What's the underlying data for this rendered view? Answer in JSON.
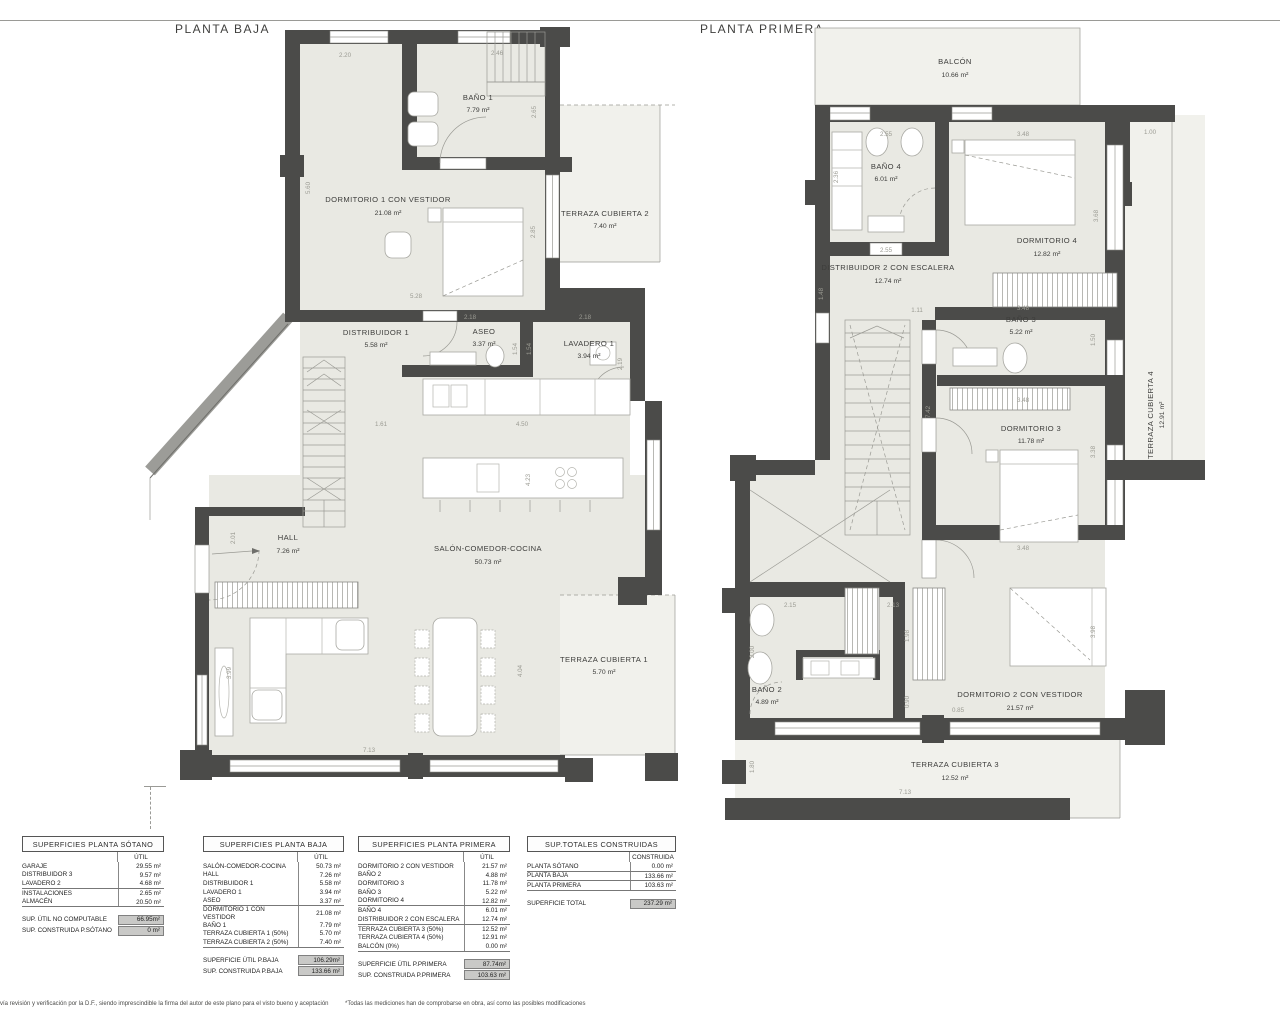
{
  "plans": {
    "baja": {
      "title": "PLANTA BAJA",
      "rooms": {
        "bano1": {
          "name": "BAÑO 1",
          "area": "7.79 m²"
        },
        "dorm1": {
          "name": "DORMITORIO 1 CON VESTIDOR",
          "area": "21.08 m²"
        },
        "terr2": {
          "name": "TERRAZA CUBIERTA 2",
          "area": "7.40 m²"
        },
        "dist1": {
          "name": "DISTRIBUIDOR 1",
          "area": "5.58 m²"
        },
        "aseo": {
          "name": "ASEO",
          "area": "3.37 m²"
        },
        "lav1": {
          "name": "LAVADERO 1",
          "area": "3.94 m²"
        },
        "hall": {
          "name": "HALL",
          "area": "7.26 m²"
        },
        "salon": {
          "name": "SALÓN-COMEDOR-COCINA",
          "area": "50.73 m²"
        },
        "terr1": {
          "name": "TERRAZA CUBIERTA 1",
          "area": "5.70 m²"
        }
      },
      "dims": [
        "2.20",
        "2.46",
        "5.60",
        "2.65",
        "2.85",
        "5.28",
        "2.18",
        "2.18",
        "1.54",
        "1.54",
        "2.19",
        "1.61",
        "4.50",
        "4.23",
        "2.01",
        "3.99",
        "7.13",
        "4.04"
      ]
    },
    "primera": {
      "title": "PLANTA PRIMERA",
      "rooms": {
        "balcon": {
          "name": "BALCÓN",
          "area": "10.66 m²"
        },
        "bano4": {
          "name": "BAÑO 4",
          "area": "6.01 m²"
        },
        "dorm4": {
          "name": "DORMITORIO 4",
          "area": "12.82 m²"
        },
        "dist2": {
          "name": "DISTRIBUIDOR 2 CON ESCALERA",
          "area": "12.74 m²"
        },
        "bano3": {
          "name": "BAÑO 3",
          "area": "5.22 m²"
        },
        "dorm3": {
          "name": "DORMITORIO 3",
          "area": "11.78 m²"
        },
        "terr4": {
          "name": "TERRAZA CUBIERTA 4",
          "area": "12.91 m²"
        },
        "bano2": {
          "name": "BAÑO 2",
          "area": "4.89 m²"
        },
        "dorm2": {
          "name": "DORMITORIO 2 CON VESTIDOR",
          "area": "21.57 m²"
        },
        "terr3": {
          "name": "TERRAZA CUBIERTA 3",
          "area": "12.52 m²"
        }
      },
      "dims": [
        "2.55",
        "3.48",
        "1.00",
        "2.36",
        "3.68",
        "2.55",
        "1.48",
        "1.11",
        "3.48",
        "1.50",
        "7.42",
        "3.48",
        "3.38",
        "3.48",
        "2.15",
        "2.13",
        "1.98",
        "2.00",
        "0.90",
        "0.85",
        "3.98",
        "1.80",
        "7.13"
      ]
    }
  },
  "tables": [
    {
      "title": "SUPERFICIES PLANTA SÓTANO",
      "col_header": "ÚTIL",
      "groups": [
        [
          [
            "GARAJE",
            "29.55 m²"
          ],
          [
            "DISTRIBUIDOR 3",
            "9.57 m²"
          ],
          [
            "LAVADERO 2",
            "4.68 m²"
          ]
        ],
        [
          [
            "INSTALACIONES",
            "2.65 m²"
          ],
          [
            "ALMACÉN",
            "20.50 m²"
          ]
        ]
      ],
      "totals": [
        [
          "SUP. ÚTIL NO COMPUTABLE",
          "66.95m²"
        ],
        [
          "SUP. CONSTRUIDA P.SÓTANO",
          "0 m²"
        ]
      ]
    },
    {
      "title": "SUPERFICIES PLANTA BAJA",
      "col_header": "ÚTIL",
      "groups": [
        [
          [
            "SALÓN-COMEDOR-COCINA",
            "50.73 m²"
          ],
          [
            "HALL",
            "7.26 m²"
          ],
          [
            "DISTRIBUIDOR 1",
            "5.58 m²"
          ],
          [
            "LAVADERO 1",
            "3.94 m²"
          ],
          [
            "ASEO",
            "3.37 m²"
          ]
        ],
        [
          [
            "DORMITORIO 1 CON VESTIDOR",
            "21.08 m²"
          ],
          [
            "BAÑO 1",
            "7.79 m²"
          ],
          [
            "TERRAZA CUBIERTA 1 (50%)",
            "5.70 m²"
          ],
          [
            "TERRAZA CUBIERTA 2 (50%)",
            "7.40 m²"
          ]
        ]
      ],
      "totals": [
        [
          "SUPERFICIE ÚTIL P.BAJA",
          "106.29m²"
        ],
        [
          "SUP. CONSTRUIDA P.BAJA",
          "133.66 m²"
        ]
      ]
    },
    {
      "title": "SUPERFICIES PLANTA PRIMERA",
      "col_header": "ÚTIL",
      "groups": [
        [
          [
            "DORMITORIO 2 CON VESTIDOR",
            "21.57 m²"
          ],
          [
            "BAÑO 2",
            "4.88 m²"
          ],
          [
            "DORMITORIO 3",
            "11.78 m²"
          ],
          [
            "BAÑO 3",
            "5.22 m²"
          ],
          [
            "DORMITORIO 4",
            "12.82 m²"
          ]
        ],
        [
          [
            "BAÑO 4",
            "6.01 m²"
          ],
          [
            "DISTRIBUIDOR 2 CON ESCALERA",
            "12.74 m²"
          ]
        ],
        [
          [
            "TERRAZA CUBIERTA 3 (50%)",
            "12.52 m²"
          ],
          [
            "TERRAZA CUBIERTA 4 (50%)",
            "12.91 m²"
          ],
          [
            "BALCÓN (0%)",
            "0.00 m²"
          ]
        ]
      ],
      "totals": [
        [
          "SUPERFICIE ÚTIL P.PRIMERA",
          "87.74m²"
        ],
        [
          "SUP. CONSTRUIDA P.PRIMERA",
          "103.63 m²"
        ]
      ]
    },
    {
      "title": "SUP.TOTALES CONSTRUIDAS",
      "col_header": "CONSTRUIDA",
      "groups": [
        [
          [
            "PLANTA SÓTANO",
            "0.00 m²"
          ]
        ],
        [
          [
            "PLANTA BAJA",
            "133.66 m²"
          ]
        ],
        [
          [
            "PLANTA PRIMERA",
            "103.63 m²"
          ]
        ]
      ],
      "totals": [
        [
          "SUPERFICIE TOTAL",
          "237.29 m²"
        ]
      ]
    }
  ],
  "footer": {
    "left": "vía revisión y verificación por la D.F., siendo imprescindible la firma del autor de este plano para el visto bueno y aceptación",
    "right": "*Todas las mediciones han de comprobarse en obra, así como las posibles modificaciones"
  }
}
